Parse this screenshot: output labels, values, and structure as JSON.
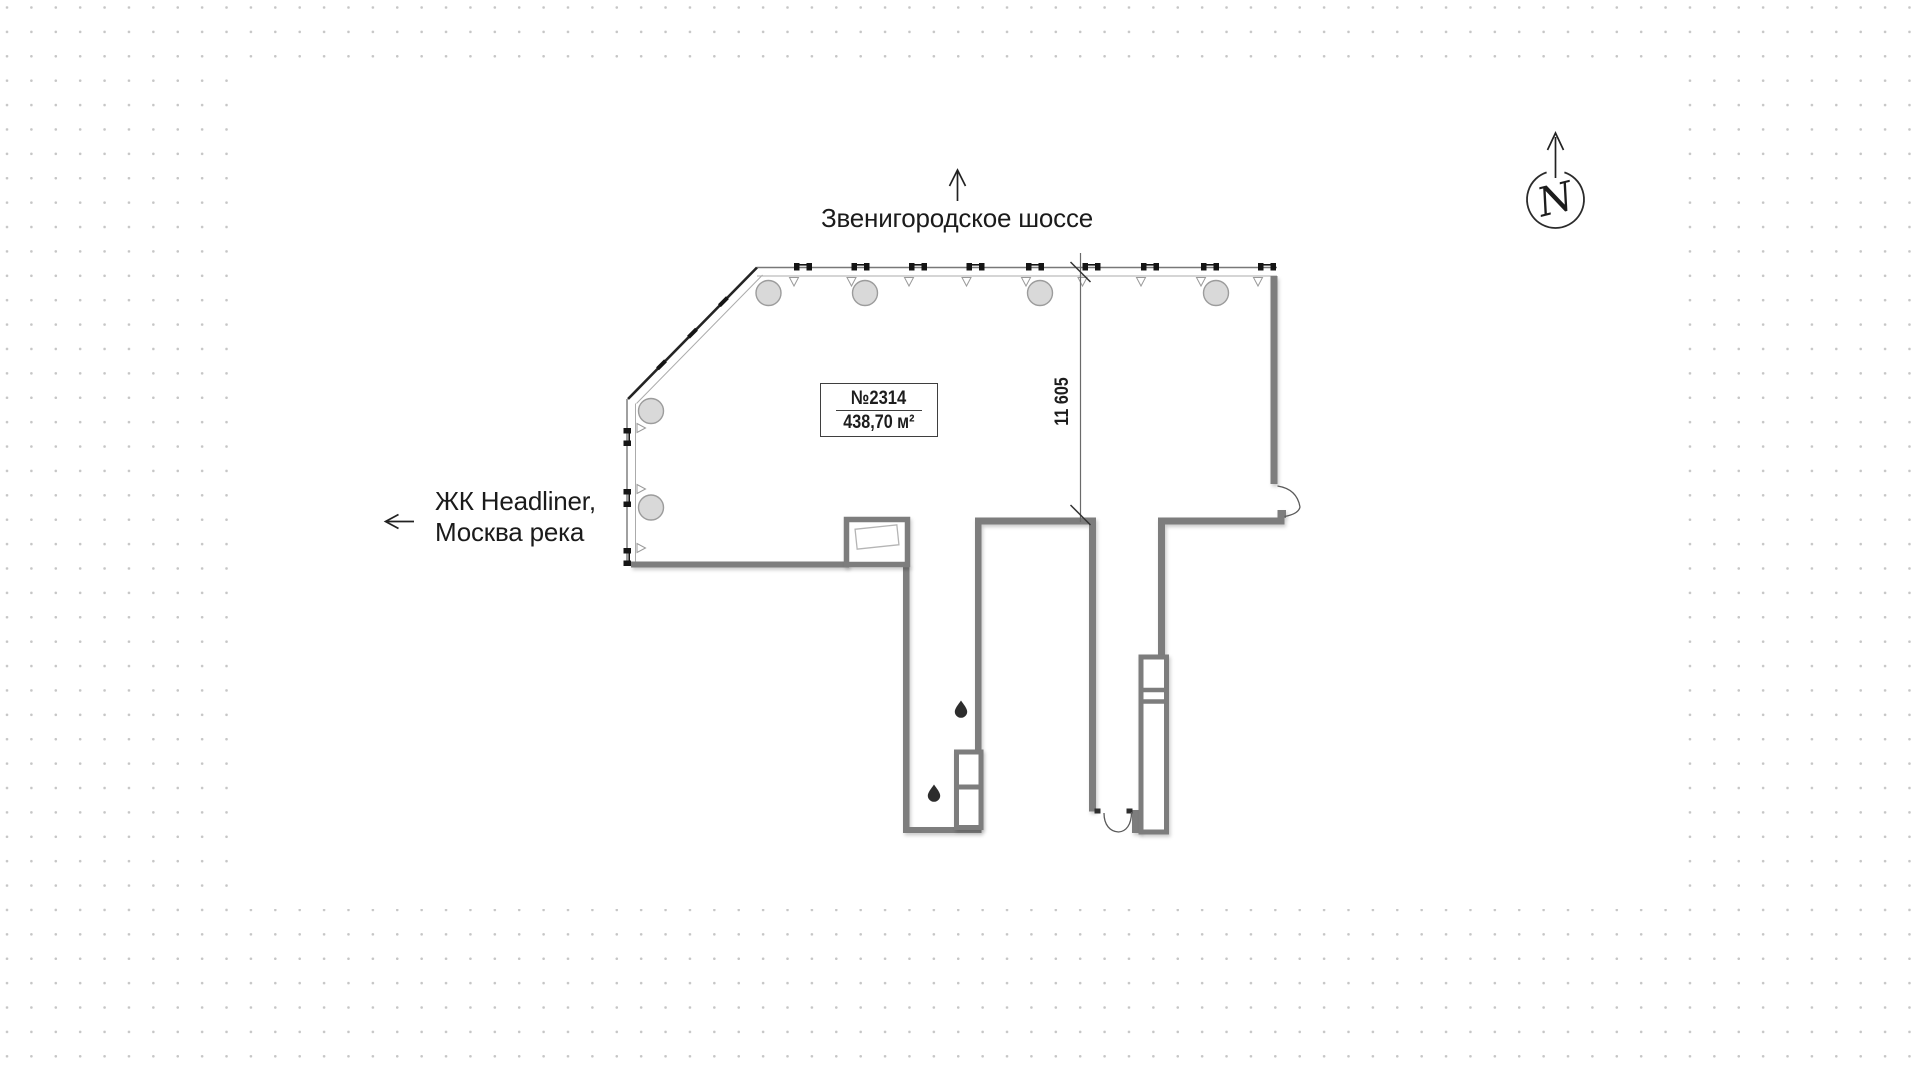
{
  "plan": {
    "unit_number": "№2314",
    "unit_area": "438,70 м²",
    "dimension_width": "11 605"
  },
  "labels": {
    "street": "Звенигородское шоссе",
    "landmark_line1": "ЖК Headliner,",
    "landmark_line2": "Москва река"
  },
  "compass": {
    "letter": "N"
  },
  "colors": {
    "wall_gray": "#7d7d7d",
    "glazing_line": "#a9a9a9",
    "mullion_black": "#151515",
    "column_fill": "#d9d9d9",
    "column_stroke": "#9c9c9c",
    "background_dot": "#c6c6c6",
    "text": "#1b1b1b"
  }
}
